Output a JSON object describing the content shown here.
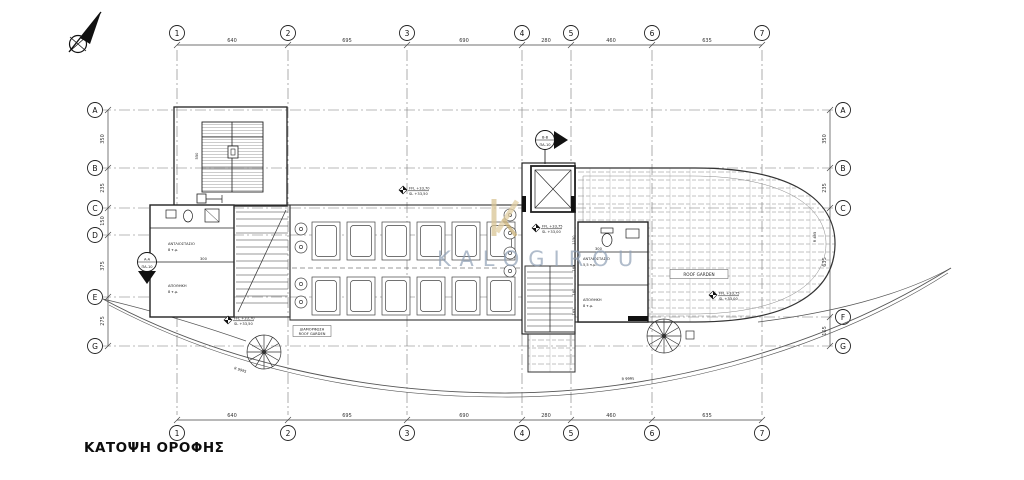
{
  "title": "ΚΑΤΟΨΗ ΟΡΟΦΗΣ",
  "watermark": {
    "text": "KALOGIROU",
    "logo_letter": "K",
    "text_color": "#8fa0b6",
    "logo_color": "#d9c595"
  },
  "grid": {
    "cols": [
      "1",
      "2",
      "3",
      "4",
      "5",
      "6",
      "7"
    ],
    "rows_left": [
      "A",
      "B",
      "C",
      "D",
      "E",
      "G"
    ],
    "rows_right": [
      "A",
      "B",
      "C",
      "F",
      "G"
    ],
    "col_dims": [
      "640",
      "695",
      "690",
      "280",
      "460",
      "635"
    ],
    "row_dims_left": [
      "350",
      "235",
      "150",
      "375",
      "275"
    ],
    "row_dims_right": [
      "350",
      "235",
      "635",
      "165"
    ]
  },
  "sections": {
    "aa": {
      "name": "A-A",
      "ref": "ΠΑ-10"
    },
    "bb": {
      "name": "B-B",
      "ref": "ΠΑ-10"
    }
  },
  "levels": [
    {
      "ffl": "FFL +33,70",
      "sl": "SL +33,50"
    },
    {
      "ffl": "FFL +33,75",
      "sl": "SL +33,00"
    },
    {
      "ffl": "FFL +33,70",
      "sl": "SL +33,50"
    },
    {
      "ffl": "FFL +33,75",
      "sl": "SL +33,00"
    }
  ],
  "rooms": {
    "left_pump": {
      "name": "ΑΝΤΛΙΟΣΤΑΣΙΟ",
      "area": "8 τ.μ."
    },
    "left_store": {
      "name": "ΑΠΟΘΗΚΗ",
      "area": "8 τ.μ."
    },
    "right_pump": {
      "name": "ΑΝΤΛΙΟΣΤΑΣΙΟ",
      "area": "5,5 τ.μ."
    },
    "right_store": {
      "name": "ΑΠΟΘΗΚΗ",
      "area": "8 τ.μ."
    }
  },
  "labels": {
    "roof_garden": "ROOF GARDEN",
    "box_line1": "ΔΙΑΜΟΡΦΩΣΗ",
    "box_line2": "ROOF GARDEN",
    "radius_right": "R 495",
    "radius_curve1": "R 9995",
    "radius_curve2": "R 9995"
  },
  "interior_dims": [
    "550",
    "300",
    "1150",
    "300",
    "165",
    "160",
    "165"
  ]
}
